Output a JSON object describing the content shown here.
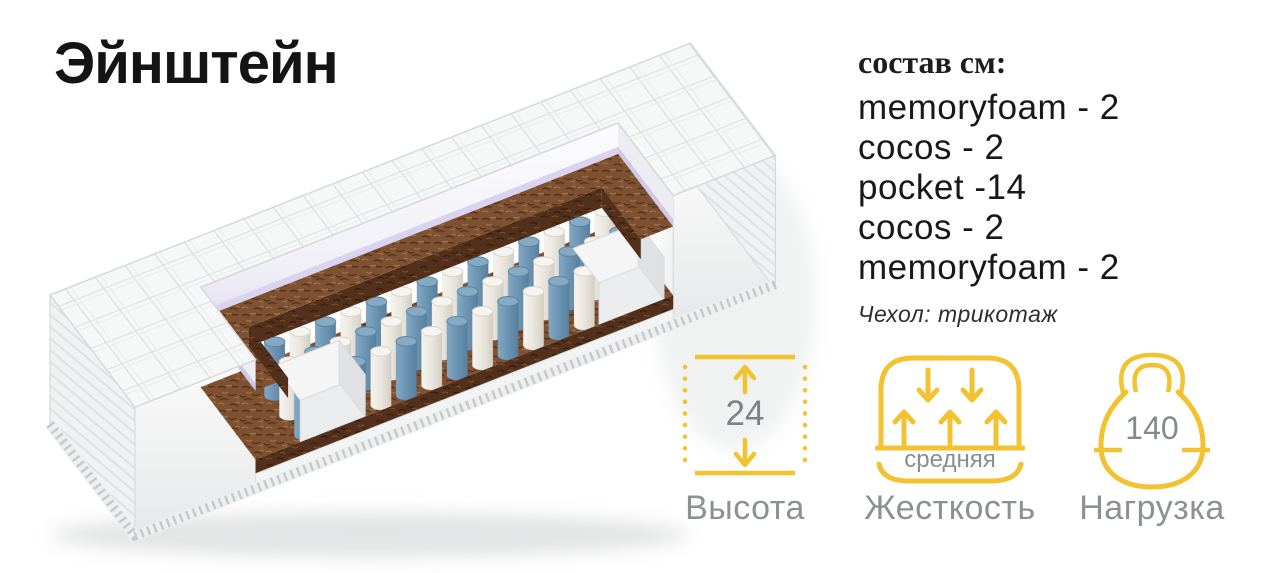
{
  "product": {
    "title": "Эйнштейн"
  },
  "composition": {
    "heading": "состав см:",
    "layers": [
      "memoryfoam - 2",
      "cocos - 2",
      "pocket -14",
      "cocos - 2",
      "memoryfoam - 2"
    ],
    "cover_note": "Чехол: трикотаж"
  },
  "specs": [
    {
      "id": "height",
      "value": "24",
      "label": "Высота"
    },
    {
      "id": "firmness",
      "value": "средняя",
      "label": "Жесткость"
    },
    {
      "id": "load",
      "value": "140",
      "label": "Нагрузка"
    }
  ],
  "colors": {
    "accent_yellow": "#F2C230",
    "label_gray": "#8d9194",
    "coir_brown": "#7d5132",
    "spring_blue": "#6b93b2",
    "foam_lavender": "#d9d3f0"
  }
}
